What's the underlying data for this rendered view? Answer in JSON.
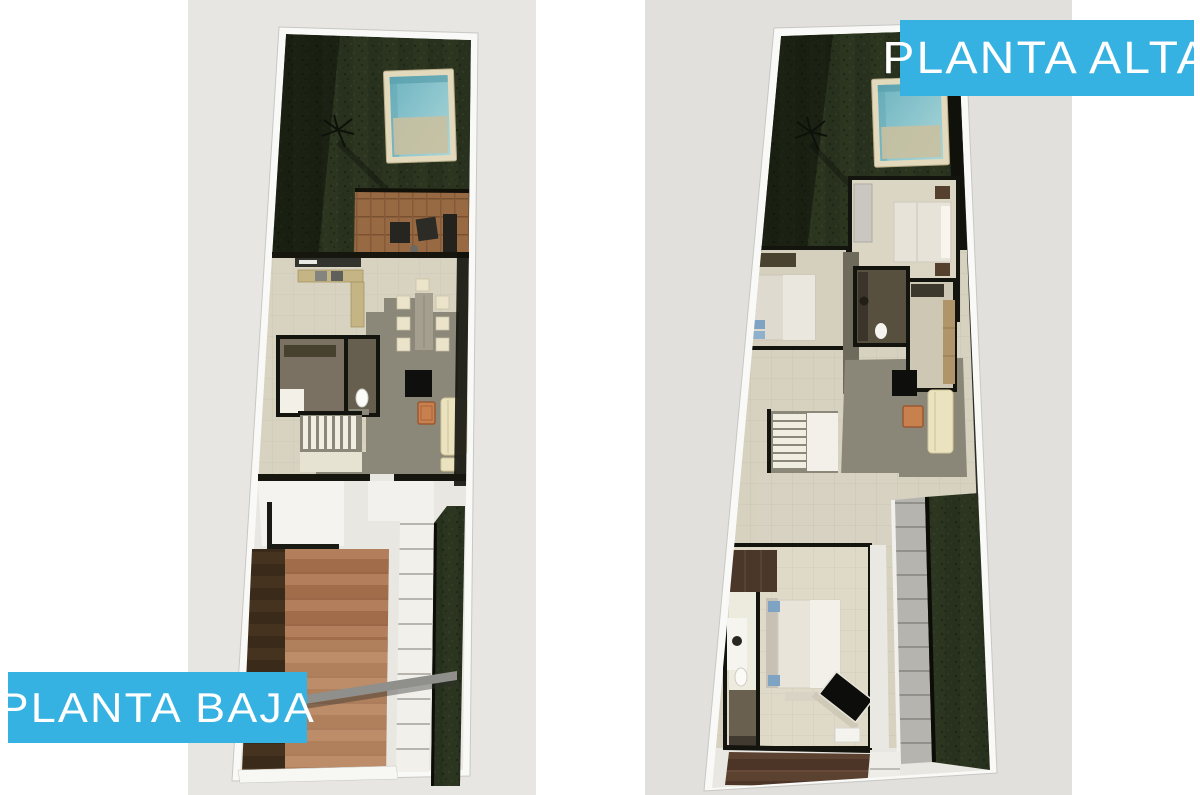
{
  "page": {
    "background_color": "#ffffff",
    "description": "Two 3D architectural floor plan renders of a narrow-lot house, ground floor left and upper floor right, each on a light gray backdrop with a cyan title plate."
  },
  "labels": {
    "planta_baja": "PLANTA BAJA",
    "planta_alta": "PLANTA ALTA"
  },
  "styles": {
    "label_plate": "background-color:#35b2e2;color:#ffffff"
  },
  "colors": {
    "label_background": "#35b2e2",
    "label_text": "#ffffff",
    "render_background_left": "#e7e6e3",
    "render_background_right": "#e1e0dd",
    "garden_green": "#2b3520",
    "pool_water": "#7fb7c2",
    "pool_frame": "#e3dabd",
    "wood_deck": "#986a43",
    "interior_floor_beige": "#d8d3c1",
    "interior_floor_gray": "#8b8779",
    "wall_dark": "#14140f",
    "wall_white": "#f9f9f7",
    "driveway_terracotta": "#b27e5b",
    "sofa_cream": "#ebe3bf",
    "coffee_table_orange": "#c8814e"
  },
  "plans": [
    {
      "name": "planta-baja",
      "position": "left",
      "features_visible": [
        "rear garden lawn",
        "swimming pool with deck frame",
        "wood deck with lounge furniture",
        "kitchen counters",
        "dining table with chairs",
        "guest bathroom with toilet",
        "staircase",
        "living room with sofa, orange coffee table and tv unit",
        "entry porch",
        "two-tone driveway",
        "stepping-stone walkway",
        "side garden strip",
        "entry gate beam"
      ]
    },
    {
      "name": "planta-alta",
      "position": "right",
      "features_visible": [
        "rear garden lawn",
        "swimming pool with deck frame",
        "rear bedroom with double bed",
        "second bedroom",
        "two bathrooms",
        "corridor",
        "family room with sofa, orange coffee table and tv unit",
        "staircase",
        "master bedroom with ensuite bathroom",
        "angled tv unit",
        "side tiled walkway",
        "side garden strip",
        "driveway visible below"
      ]
    }
  ]
}
